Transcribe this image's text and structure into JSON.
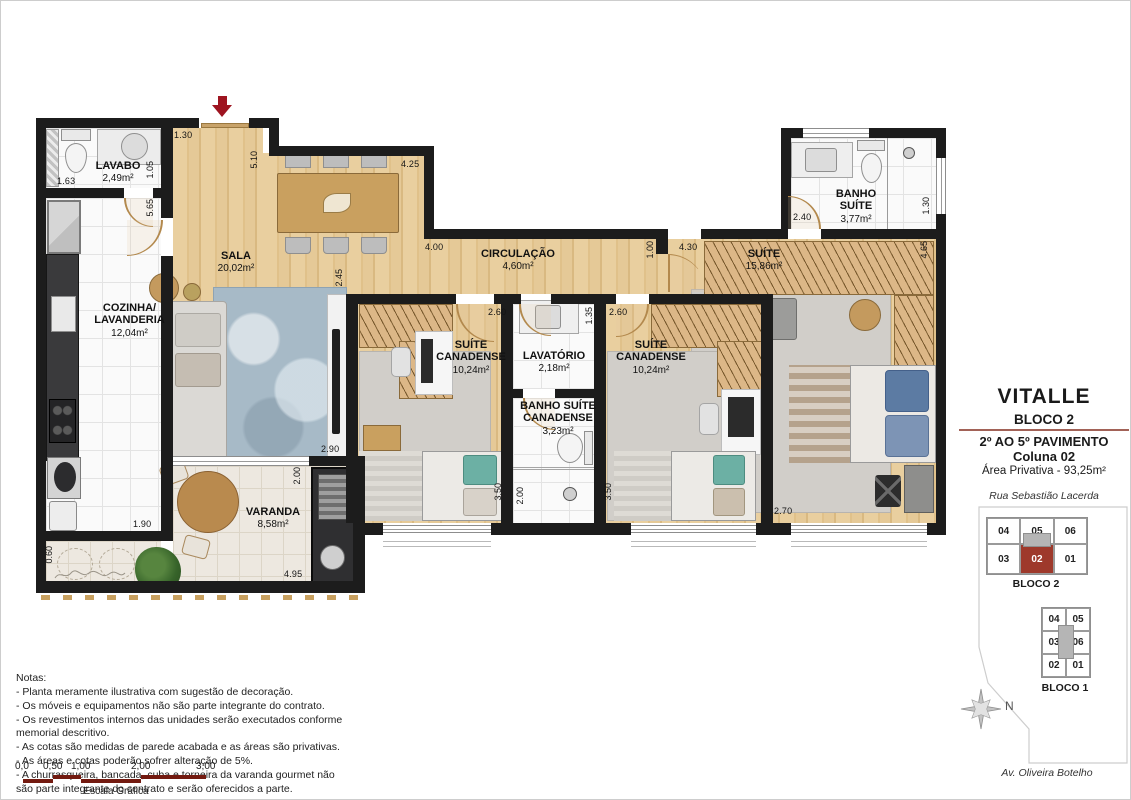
{
  "plan": {
    "rooms": [
      {
        "name": "LAVABO",
        "area": "2,49m²"
      },
      {
        "name": "SALA",
        "area": "20,02m²"
      },
      {
        "name": "COZINHA/\nLAVANDERIA",
        "area": "12,04m²"
      },
      {
        "name": "CIRCULAÇÃO",
        "area": "4,60m²"
      },
      {
        "name": "SUÍTE",
        "area": "15,86m²"
      },
      {
        "name": "BANHO\nSUÍTE",
        "area": "3,77m²"
      },
      {
        "name": "SUÍTE\nCANADENSE",
        "area": "10,24m²"
      },
      {
        "name": "LAVATÓRIO",
        "area": "2,18m²"
      },
      {
        "name": "BANHO SUÍTE\nCANADENSE",
        "area": "3,23m²"
      },
      {
        "name": "SUÍTE\nCANADENSE",
        "area": "10,24m²"
      },
      {
        "name": "VARANDA",
        "area": "8,58m²"
      }
    ],
    "dims": [
      "1.30",
      "5.10",
      "4.25",
      "1.05",
      "1.63",
      "5.65",
      "2.45",
      "4.00",
      "1.00",
      "4.30",
      "2.40",
      "1.30",
      "4.65",
      "2.60",
      "1.35",
      "2.60",
      "3.50",
      "2.00",
      "3.50",
      "2.70",
      "1.90",
      "0.60",
      "2.00",
      "2.90",
      "4.95"
    ]
  },
  "panel": {
    "title": "VITALLE",
    "block": "BLOCO 2",
    "floors": "2º AO 5º PAVIMENTO",
    "column": "Coluna 02",
    "private_area": "Área Privativa - 93,25m²",
    "street_top": "Rua Sebastião Lacerda",
    "street_bottom": "Av. Oliveira Botelho",
    "compass_north": "N",
    "bloco2": {
      "label": "BLOCO 2",
      "cells": [
        "04",
        "05",
        "06",
        "03",
        "02",
        "01"
      ],
      "highlighted_unit": "02"
    },
    "bloco1": {
      "label": "BLOCO 1",
      "cells": [
        "04",
        "05",
        "03",
        "06",
        "02",
        "01"
      ]
    }
  },
  "notes": {
    "title": "Notas:",
    "lines": [
      "- Planta meramente ilustrativa com sugestão de decoração.",
      "- Os móveis e equipamentos não são parte integrante do contrato.",
      "- Os revestimentos internos das unidades serão executados conforme",
      "  memorial descritivo.",
      "- As cotas são medidas de parede acabada e as áreas são privativas.",
      "- As áreas e cotas poderão sofrer alteração de 5%.",
      "- A churrasqueira, bancada, cuba e torneira da varanda gourmet não",
      "são parte integrante do contrato e serão oferecidos a parte."
    ]
  },
  "scalebar": {
    "labels": [
      "0,0",
      "0,50",
      "1,00",
      "2,00",
      "3,00"
    ],
    "caption": "Escala Gráfica"
  },
  "colors": {
    "wall": "#1c1c1c",
    "accent_red": "#9e1420",
    "keyplan_red": "#9e392b",
    "scalebar_red": "#731a10",
    "divider": "#a26257"
  }
}
